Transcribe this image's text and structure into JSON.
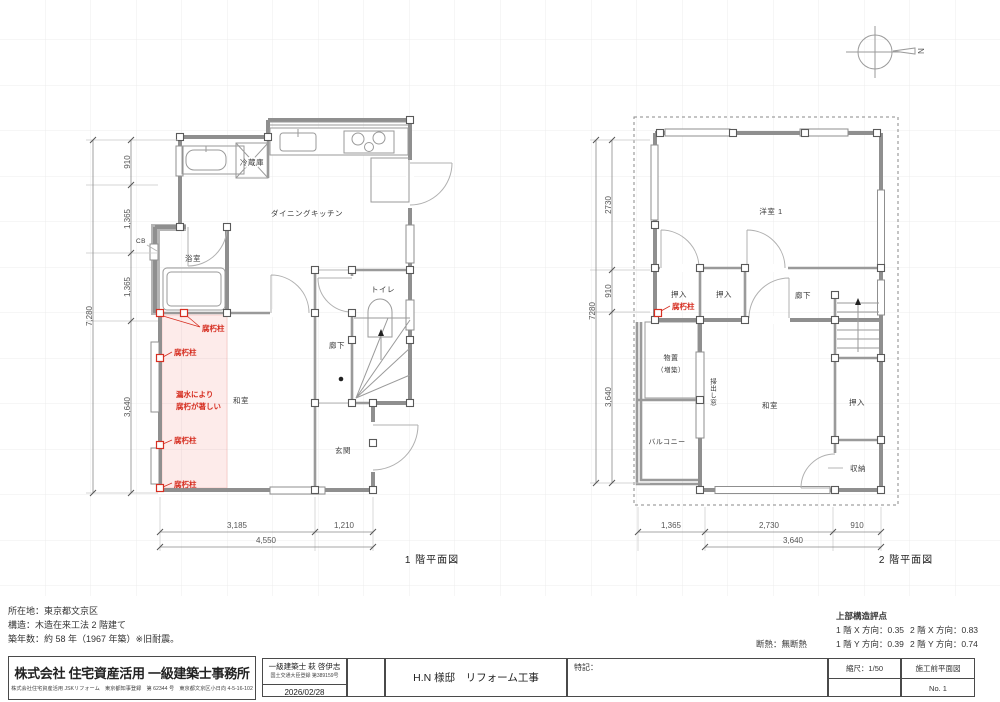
{
  "north_label": "N",
  "floor1": {
    "title": "1 階平面図",
    "rooms": {
      "dk": "ダイニングキッチン",
      "fridge": "冷蔵庫",
      "bath": "浴室",
      "cb": "CB",
      "toilet": "トイレ",
      "hall": "廊下",
      "washitsu": "和室",
      "genkan": "玄関"
    },
    "annotations": {
      "decay_post": "腐朽柱",
      "leak_1": "漏水により",
      "leak_2": "腐朽が著しい"
    },
    "dims_left": [
      "910",
      "1,365",
      "1,365",
      "3,640"
    ],
    "dims_left_total": "7,280",
    "dims_bottom": [
      "3,185",
      "1,210"
    ],
    "dims_bottom_total": "4,550"
  },
  "floor2": {
    "title": "2 階平面図",
    "rooms": {
      "yoshitsu1": "洋室 1",
      "oshiire_a": "押入",
      "oshiire_b": "押入",
      "hall": "廊下",
      "monooki": "物置",
      "monooki_sub": "（増築）",
      "balcony": "バルコニー",
      "hakidashi": "掃出し窓",
      "washitsu": "和室",
      "oshiire_c": "押入",
      "shuno": "収納"
    },
    "annotations": {
      "decay_post": "腐朽柱"
    },
    "dims_left": [
      "2730",
      "910",
      "3,640"
    ],
    "dims_left_total": "7280",
    "dims_bottom": [
      "1,365",
      "2,730",
      "910"
    ],
    "dims_bottom_total": "3,640"
  },
  "site_info": {
    "location": "所在地：東京都文京区",
    "structure": "構造：木造在来工法 2 階建て",
    "age": "築年数：約 58 年（1967 年築）※旧耐震。"
  },
  "scores": {
    "heading": "上部構造評点",
    "f1x": "1 階 X 方向：0.35",
    "f2x": "2 階 X 方向：0.83",
    "f1y": "1 階 Y 方向：0.39",
    "f2y": "2 階 Y 方向：0.74",
    "insulation": "断熱：無断熱"
  },
  "titleblock": {
    "company": "株式会社 住宅資産活用 一級建築士事務所",
    "company_sub": "株式会社住宅資産活用 JSKリフォーム　東京都知事登録　第 62344 号　東京都文京区小日向 4-5-16-102",
    "architect": "一級建築士 萩 啓伊志",
    "architect_reg": "国土交通大臣登録 第389159号",
    "date": "2026/02/28",
    "project": "H.N 様邸　リフォーム工事",
    "notes": "特記：",
    "scale": "縮尺：1/50",
    "sheet": "施工前平面図",
    "number": "No. 1"
  }
}
